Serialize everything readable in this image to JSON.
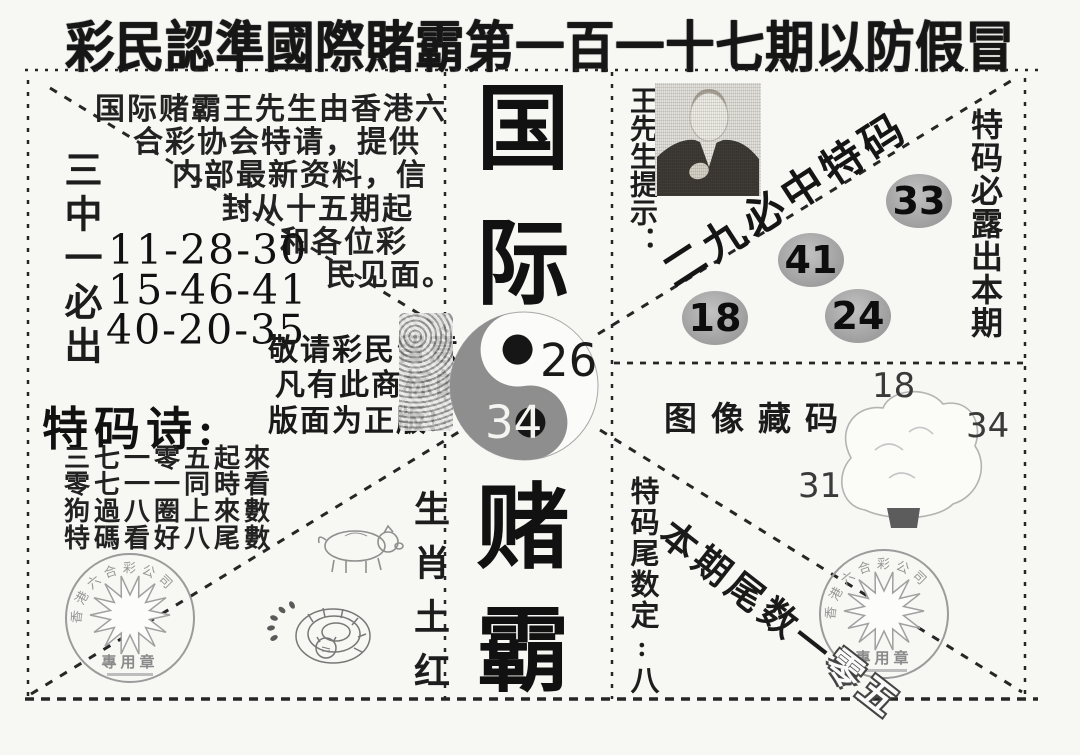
{
  "banner": {
    "text": "彩民認準國際賭霸第一百一十七期以防假冒"
  },
  "intro": {
    "lines": [
      "国际赌霸王先生由香港六",
      "合彩协会特请，提供",
      "内部最新资料，信",
      "封从十五期起",
      "和各位彩",
      "民见面。"
    ]
  },
  "pick_three": {
    "label": "三中一必出",
    "rows": [
      "11-28-30",
      "15-46-41",
      "40-20-35"
    ]
  },
  "notice": {
    "lines": [
      "敬请彩民留意",
      "凡有此商标的",
      "版面为正版!"
    ]
  },
  "poem": {
    "title": "特码诗:",
    "lines": [
      "三七一零五起來",
      "零七一一同時看",
      "狗過八圈上來數",
      "特碼看好八尾數"
    ]
  },
  "center": {
    "title_chars": [
      "国",
      "际",
      "赌",
      "霸"
    ],
    "yinyang": {
      "top_number": "26",
      "bottom_number": "34"
    }
  },
  "zodiac": {
    "label": "生肖土红"
  },
  "tail_hint": {
    "label": "特码尾数定:八"
  },
  "top_right": {
    "presenter": "王先生提示：",
    "slogan": "二九必中特码",
    "balls": [
      "18",
      "41",
      "24",
      "33"
    ],
    "column": "特码必露出本期"
  },
  "image_code": {
    "label": "图像藏码",
    "numbers": {
      "top": "18",
      "right": "34",
      "left": "31"
    }
  },
  "bottom_right": {
    "diagonal_prefix": "本期尾数一",
    "diagonal_knockout": "零五"
  },
  "seal": {
    "arc_text": "香港六合彩公司",
    "label": "專用章"
  },
  "colors": {
    "ink": "#1c1c1c",
    "yinyang_gray": "#8e8e8e",
    "ball_gray": "#a3a3a3"
  }
}
